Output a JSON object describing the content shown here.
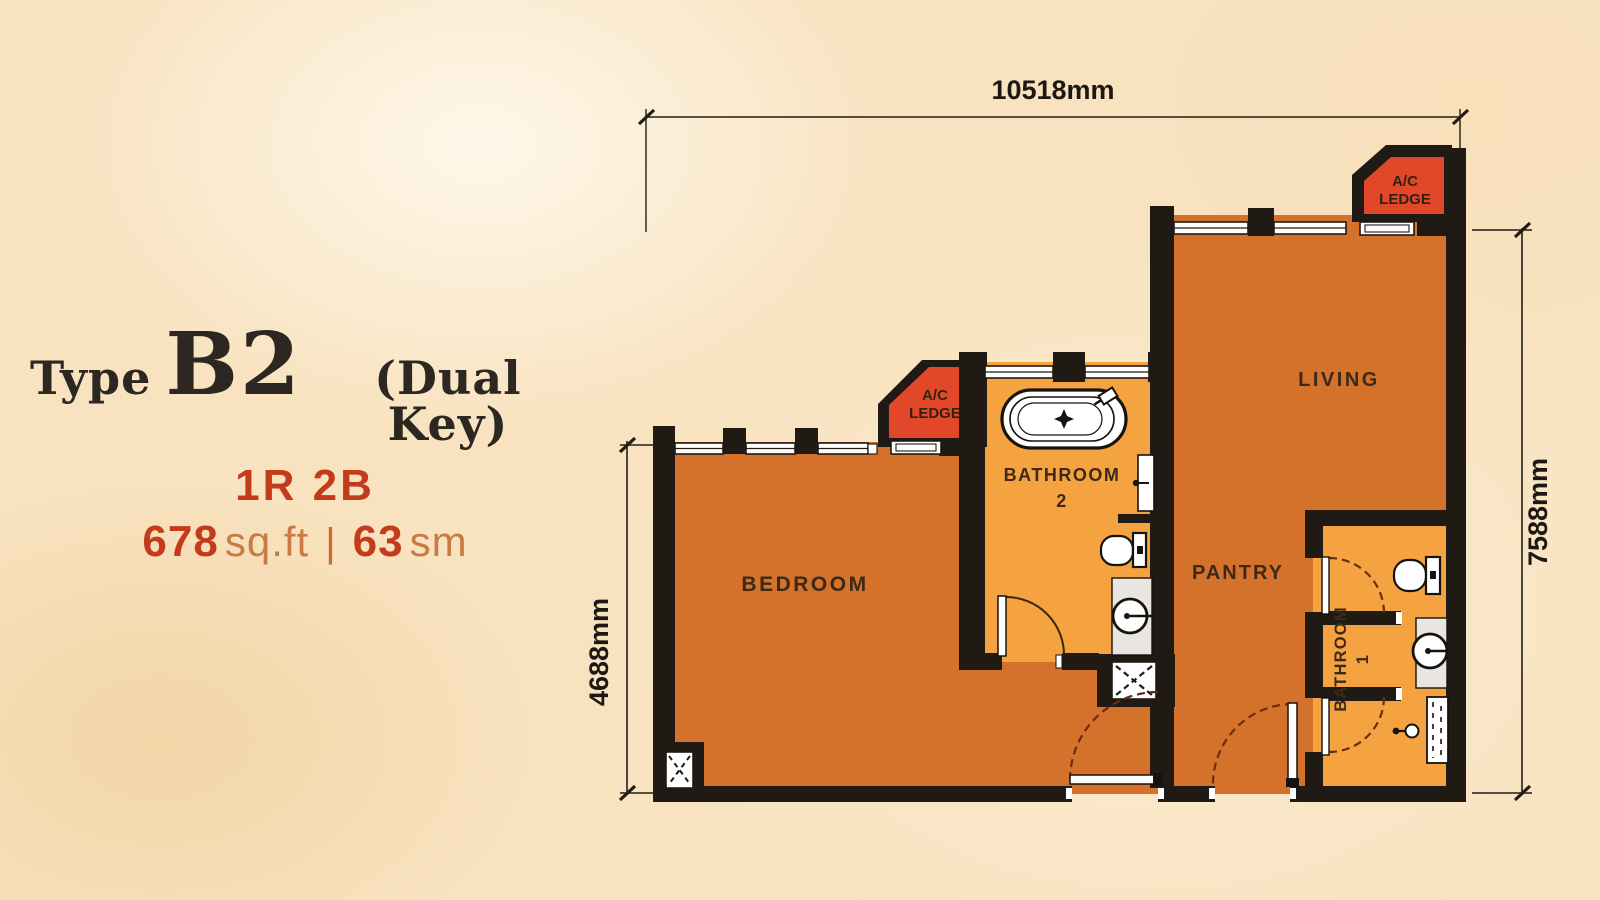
{
  "title": {
    "prefix": "Type",
    "type_code": "B2",
    "suffix": "(Dual Key)",
    "config": "1R 2B",
    "area_sqft": "678",
    "area_sqft_unit": "sq.ft",
    "separator": "|",
    "area_sm": "63",
    "area_sm_unit": "sm"
  },
  "dimensions": {
    "top": "10518mm",
    "left": "4688mm",
    "right": "7588mm"
  },
  "rooms": {
    "bedroom": "BEDROOM",
    "living": "LIVING",
    "pantry": "PANTRY",
    "bathroom2_line1": "BATHROOM",
    "bathroom2_line2": "2",
    "bathroom1_line1": "BATHROOM",
    "bathroom1_line2": "1",
    "ac_ledge_line1": "A/C",
    "ac_ledge_line2": "LEDGE"
  },
  "colors": {
    "background": "#F8E2BF",
    "floor_main": "#D4722C",
    "floor_bathroom": "#F4A340",
    "ac_ledge_red": "#E2472A",
    "wall_black": "#1F1A13",
    "room_label": "#3E2817",
    "dimension_text": "#1D1813",
    "title_text": "#2D2722",
    "accent_red": "#C43B1C",
    "accent_soft": "#CA7A45"
  }
}
